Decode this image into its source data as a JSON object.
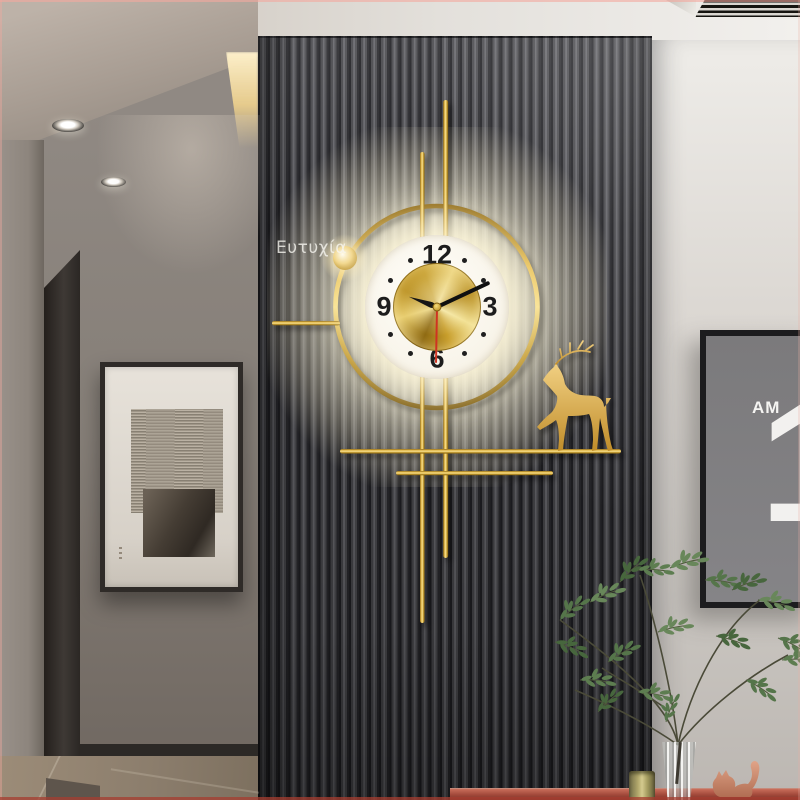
{
  "scene": {
    "watermark": "Ευτυχία"
  },
  "clock": {
    "numerals": {
      "twelve": "12",
      "three": "3",
      "six": "6",
      "nine": "9"
    },
    "hands": {
      "hour_deg": 290,
      "minute_deg": 65,
      "second_deg": 181
    },
    "colors": {
      "gold": "#d7a73e",
      "gold_light": "#f6d878",
      "face_white": "#fcfaf2",
      "second_hand_red": "#cf3322",
      "glow": "#fff3cf"
    }
  },
  "poster": {
    "small_label": "AM",
    "big_digit": "1"
  },
  "palette": {
    "panel_slat_dark": "#26262a",
    "panel_slat_light": "#65656a",
    "right_wall": "#dcd8d3",
    "hall_wall": "#857e77",
    "hall_floor": "#8b7d6c",
    "console_table_red": "#a04739",
    "plant_green": "#5c7b4b",
    "cat_terracotta": "#d3957a",
    "art_mat": "#e7e2da",
    "art_frame": "#2f2b28"
  }
}
